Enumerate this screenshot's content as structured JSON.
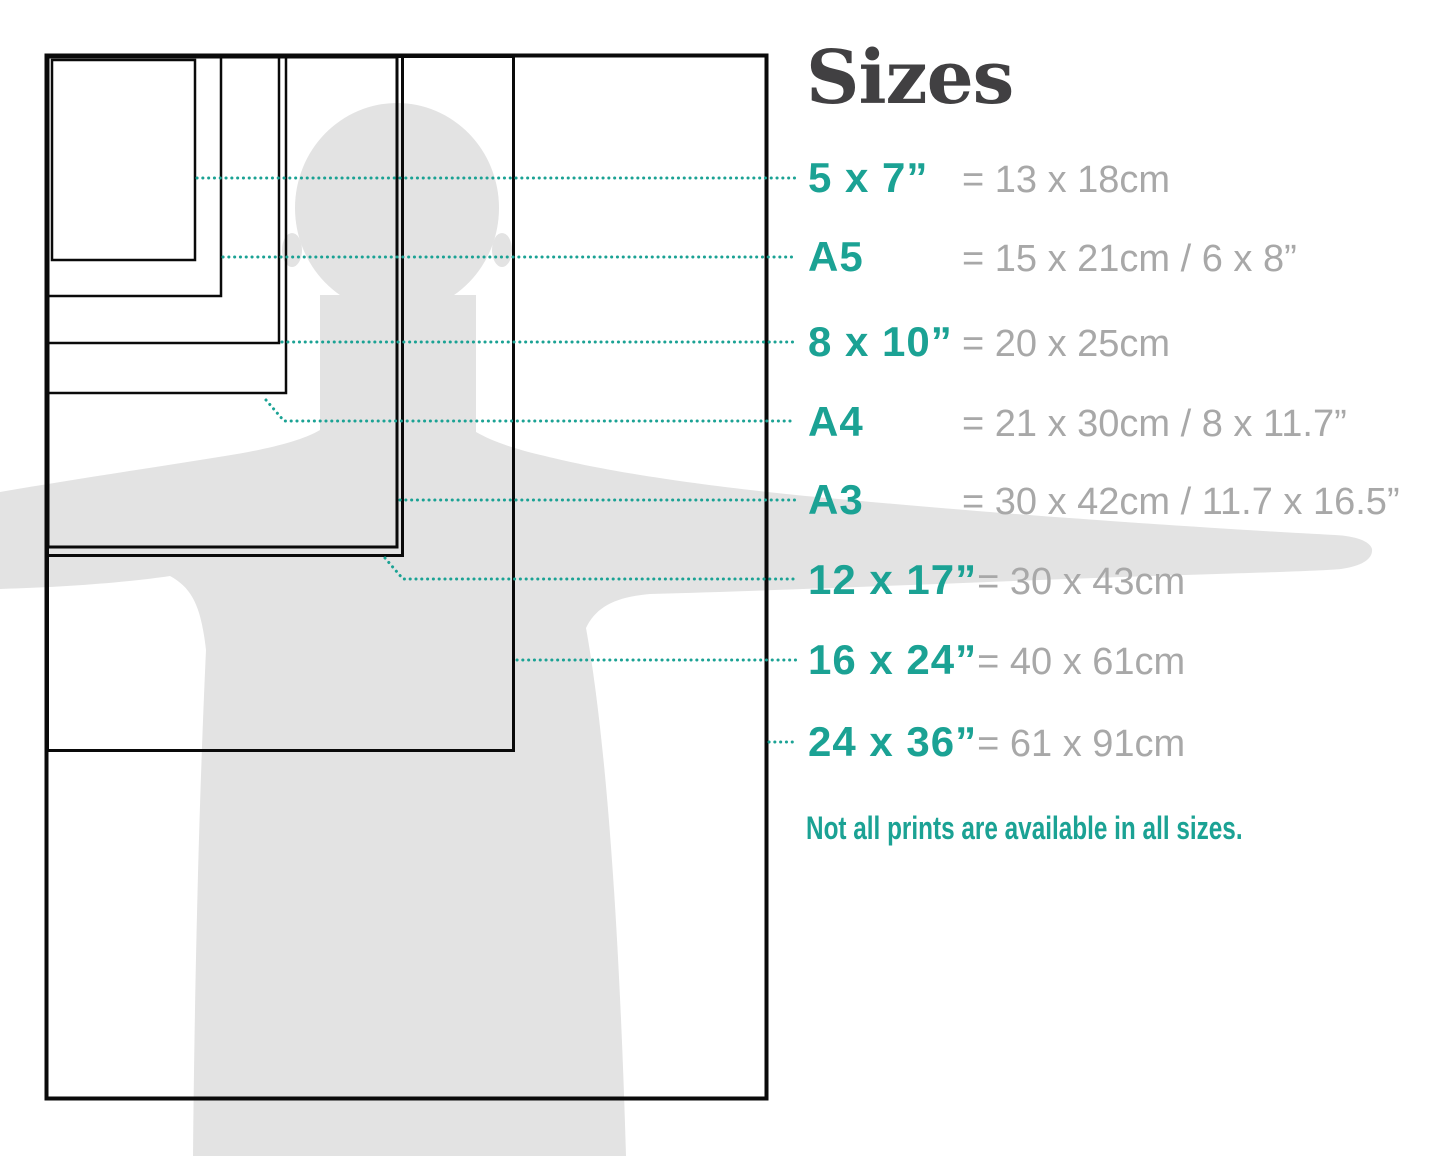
{
  "title": "Sizes",
  "note": "Not all prints are available in all sizes.",
  "colors": {
    "teal": "#1BA294",
    "value_gray": "#A8A8A8",
    "title_gray": "#414042",
    "silhouette_gray": "#E3E3E3",
    "frame_black": "#0A0A0A"
  },
  "sizes": [
    {
      "id": "5x7",
      "label": "5 x 7”",
      "value": "= 13 x 18cm",
      "label_y": 178,
      "rect": {
        "x": 52,
        "y": 60,
        "w": 143,
        "h": 200
      },
      "leader": [
        [
          197,
          178
        ],
        [
          798,
          178
        ]
      ]
    },
    {
      "id": "a5",
      "label": "A5",
      "value": "= 15 x 21cm / 6 x 8”",
      "label_y": 257,
      "rect": {
        "x": 48,
        "y": 57,
        "w": 173,
        "h": 239
      },
      "leader": [
        [
          223,
          257
        ],
        [
          795,
          257
        ]
      ]
    },
    {
      "id": "8x10",
      "label": "8 x 10”",
      "value": "= 20 x 25cm",
      "label_y": 342,
      "rect": {
        "x": 48,
        "y": 57,
        "w": 231,
        "h": 286
      },
      "leader": [
        [
          282,
          342
        ],
        [
          797,
          342
        ]
      ]
    },
    {
      "id": "a4",
      "label": "A4",
      "value": "= 21 x 30cm / 8 x 11.7”",
      "label_y": 422,
      "rect": {
        "x": 48,
        "y": 57,
        "w": 238,
        "h": 336
      },
      "leader": [
        [
          266,
          400
        ],
        [
          284,
          421
        ],
        [
          795,
          421
        ]
      ]
    },
    {
      "id": "a3",
      "label": "A3",
      "value": "= 30 x 42cm / 11.7 x 16.5”",
      "label_y": 500,
      "rect": {
        "x": 48,
        "y": 57,
        "w": 349,
        "h": 490
      },
      "leader": [
        [
          400,
          500
        ],
        [
          797,
          500
        ]
      ]
    },
    {
      "id": "12x17",
      "label": "12 x 17”",
      "value": "= 30 x 43cm",
      "label_y": 580,
      "rect": {
        "x": 47.5,
        "y": 56.5,
        "w": 355,
        "h": 499
      },
      "leader": [
        [
          385,
          558
        ],
        [
          403,
          579
        ],
        [
          797,
          579
        ]
      ]
    },
    {
      "id": "16x24",
      "label": "16 x 24”",
      "value": "= 40 x 61cm",
      "label_y": 660,
      "rect": {
        "x": 47.5,
        "y": 56.5,
        "w": 466,
        "h": 694
      },
      "leader": [
        [
          517,
          660
        ],
        [
          797,
          660
        ]
      ]
    },
    {
      "id": "24x36",
      "label": "24 x 36”",
      "value": "= 61 x 91cm",
      "label_y": 742,
      "rect": {
        "x": 46.5,
        "y": 55.5,
        "w": 720,
        "h": 1043
      },
      "leader": [
        [
          769,
          742
        ],
        [
          797,
          742
        ]
      ]
    }
  ]
}
